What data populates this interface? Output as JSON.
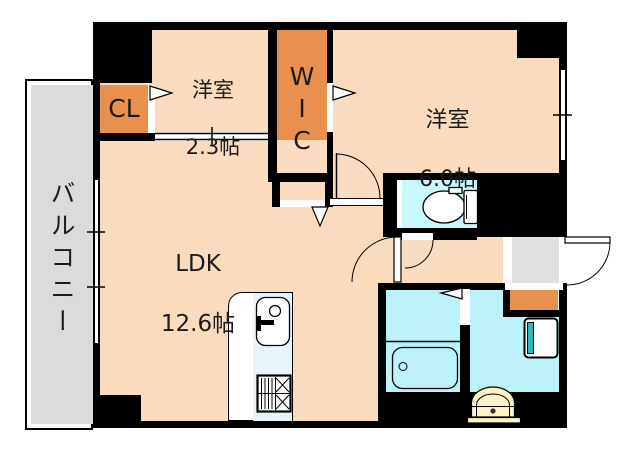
{
  "labels": {
    "balcony": "バルコニー",
    "closet": "CL",
    "walk_in_closet": "WIC",
    "bedroom_small_name": "洋室",
    "bedroom_small_size": "2.3帖",
    "bedroom_main_name": "洋室",
    "bedroom_main_size": "6.0帖",
    "ldk_name": "LDK",
    "ldk_size": "12.6帖"
  },
  "icons": {
    "toilet": "toilet-icon",
    "bathtub": "bathtub-icon",
    "washbasin": "washbasin-icon",
    "washing_machine_pan": "washing-machine-pan-icon",
    "kitchen_sink": "kitchen-sink-icon",
    "gas_stove": "gas-stove-icon"
  },
  "colors": {
    "room_fill": "#F8DCBD",
    "closet_fill": "#E8914E",
    "wet_fill": "#BDF2F8",
    "toilet_fill": "#C9F8FC",
    "balcony_fill": "#DBDBDB",
    "entry_fill": "#E2DFDF",
    "basin_fill": "#FBF3C4",
    "counter_fill": "#E7F4F9",
    "teal_accent": "#2FB8C0",
    "wall_color": "#000000",
    "line_color": "#1B1B1B"
  }
}
